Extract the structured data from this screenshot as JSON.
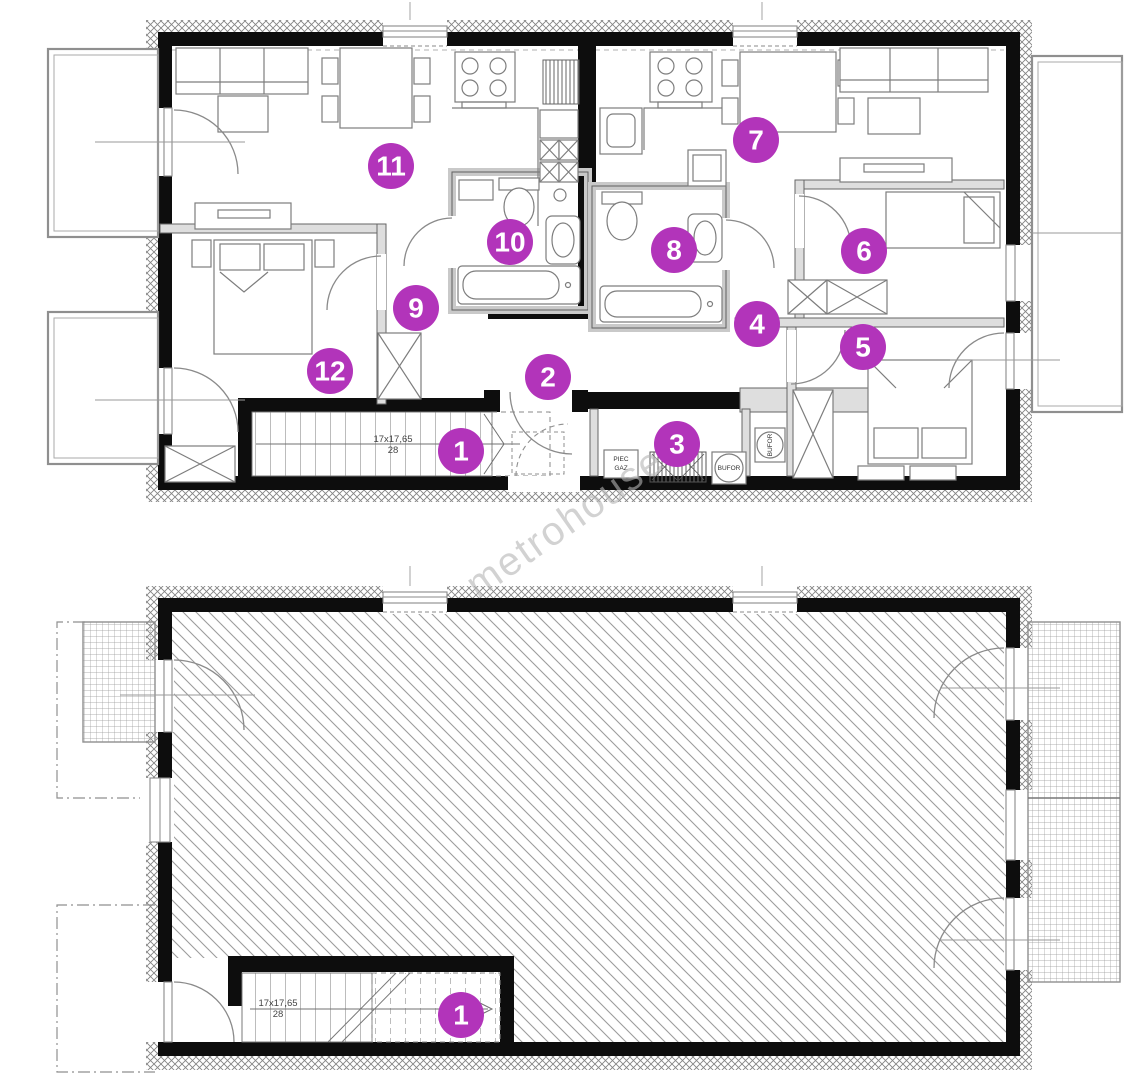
{
  "colors": {
    "marker": "#b234ba",
    "wall": "#0d0d0d",
    "hatch": "#9c9c9c",
    "watermark": "#b5b5b5"
  },
  "watermark": {
    "text": "metrohouse"
  },
  "plans": {
    "upper": {
      "name": "upper-floor-plan",
      "markers": [
        {
          "label": "1",
          "x": 461,
          "y": 451
        },
        {
          "label": "2",
          "x": 548,
          "y": 377
        },
        {
          "label": "3",
          "x": 677,
          "y": 444
        },
        {
          "label": "4",
          "x": 757,
          "y": 324
        },
        {
          "label": "5",
          "x": 863,
          "y": 347
        },
        {
          "label": "6",
          "x": 864,
          "y": 251
        },
        {
          "label": "7",
          "x": 756,
          "y": 140
        },
        {
          "label": "8",
          "x": 674,
          "y": 250
        },
        {
          "label": "9",
          "x": 416,
          "y": 308
        },
        {
          "label": "10",
          "x": 510,
          "y": 242
        },
        {
          "label": "11",
          "x": 391,
          "y": 166
        },
        {
          "label": "12",
          "x": 330,
          "y": 371
        }
      ],
      "stairs": {
        "dim": "17x17,65",
        "count": "28"
      },
      "labels": {
        "boiler_line1": "PIEC",
        "boiler_line2": "GAZ",
        "buffer1": "BUFOR",
        "buffer2": "BUFOR"
      }
    },
    "lower": {
      "name": "attic-floor-plan",
      "markers": [
        {
          "label": "1",
          "x": 461,
          "y": 1015
        }
      ],
      "stairs": {
        "dim": "17x17,65",
        "count": "28"
      }
    }
  }
}
